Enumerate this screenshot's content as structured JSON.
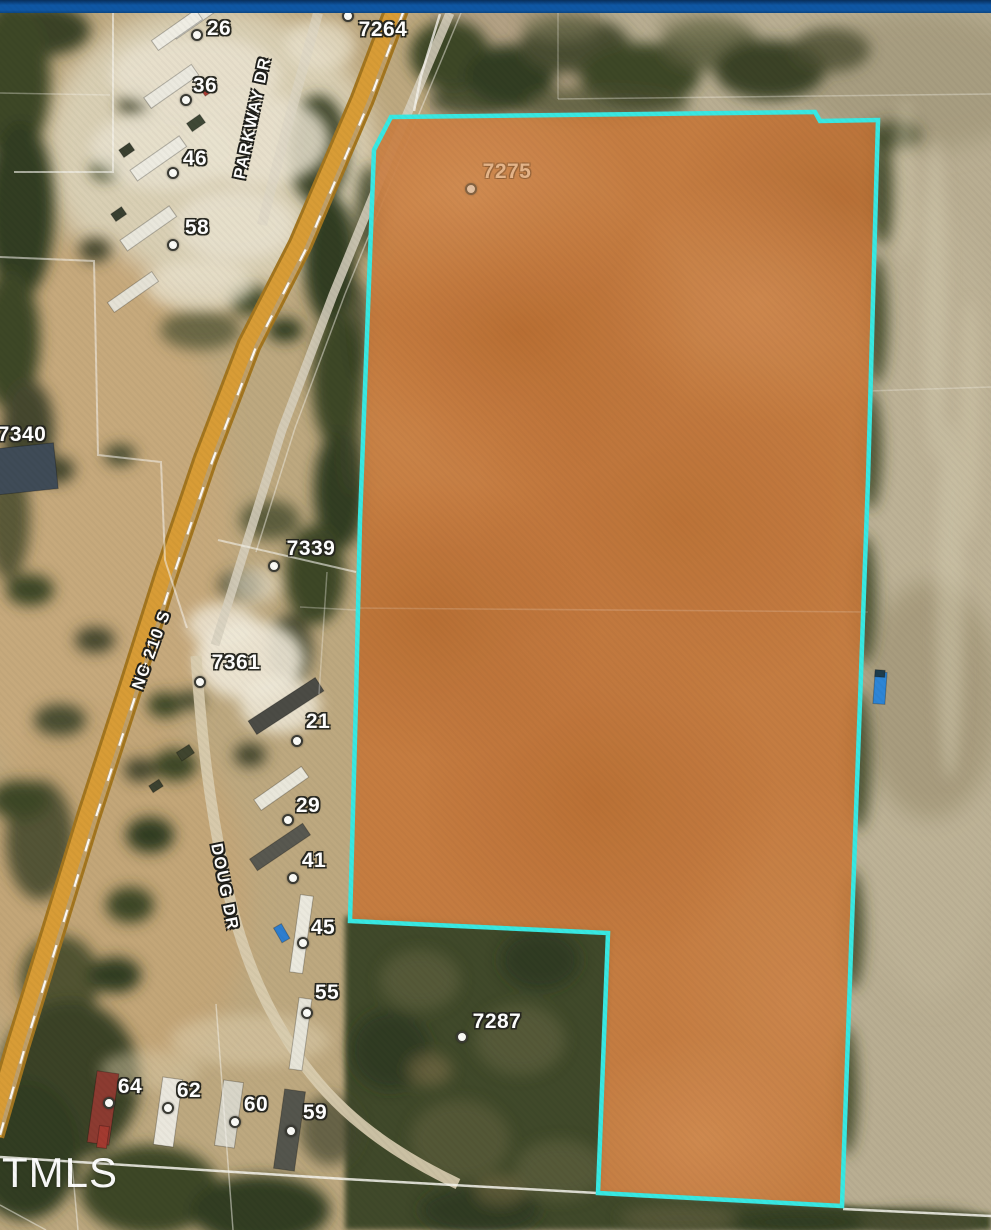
{
  "colors": {
    "header_bar": "#0f57a4",
    "parcel_outline": "#38e8e2",
    "parcel_fill": "#c5793c",
    "highway": "#d89c36"
  },
  "map": {
    "watermark": "TMLS",
    "roads": [
      {
        "text": "PARKWAY DR",
        "x": 253,
        "y": 118,
        "rot": -78
      },
      {
        "text": "NC 210 S",
        "x": 152,
        "y": 650,
        "rot": -70
      },
      {
        "text": "DOUG DR",
        "x": 224,
        "y": 887,
        "rot": 79
      }
    ],
    "addresses": [
      {
        "text": "26",
        "x": 219,
        "y": 29,
        "dot": {
          "x": 197,
          "y": 35
        }
      },
      {
        "text": "36",
        "x": 205,
        "y": 86,
        "dot": {
          "x": 186,
          "y": 100
        }
      },
      {
        "text": "46",
        "x": 195,
        "y": 159,
        "dot": {
          "x": 173,
          "y": 173
        }
      },
      {
        "text": "58",
        "x": 197,
        "y": 228,
        "dot": {
          "x": 173,
          "y": 245
        }
      },
      {
        "text": "7264",
        "x": 383,
        "y": 30,
        "dot": {
          "x": 348,
          "y": 16
        }
      },
      {
        "text": "7340",
        "x": 22,
        "y": 435
      },
      {
        "text": "7275",
        "x": 507,
        "y": 172,
        "dot": {
          "x": 471,
          "y": 189
        },
        "muted": true
      },
      {
        "text": "7339",
        "x": 311,
        "y": 549,
        "dot": {
          "x": 274,
          "y": 566
        }
      },
      {
        "text": "7361",
        "x": 236,
        "y": 663,
        "dot": {
          "x": 200,
          "y": 682
        }
      },
      {
        "text": "21",
        "x": 318,
        "y": 722,
        "dot": {
          "x": 297,
          "y": 741
        }
      },
      {
        "text": "29",
        "x": 308,
        "y": 806,
        "dot": {
          "x": 288,
          "y": 820
        }
      },
      {
        "text": "41",
        "x": 314,
        "y": 861,
        "dot": {
          "x": 293,
          "y": 878
        }
      },
      {
        "text": "45",
        "x": 323,
        "y": 928,
        "dot": {
          "x": 303,
          "y": 943
        }
      },
      {
        "text": "55",
        "x": 327,
        "y": 993,
        "dot": {
          "x": 307,
          "y": 1013
        }
      },
      {
        "text": "7287",
        "x": 497,
        "y": 1022,
        "dot": {
          "x": 462,
          "y": 1037
        }
      },
      {
        "text": "64",
        "x": 130,
        "y": 1087,
        "dot": {
          "x": 109,
          "y": 1103
        }
      },
      {
        "text": "62",
        "x": 189,
        "y": 1091,
        "dot": {
          "x": 168,
          "y": 1108
        }
      },
      {
        "text": "60",
        "x": 256,
        "y": 1105,
        "dot": {
          "x": 235,
          "y": 1122
        }
      },
      {
        "text": "59",
        "x": 315,
        "y": 1113,
        "dot": {
          "x": 291,
          "y": 1131
        }
      }
    ]
  }
}
